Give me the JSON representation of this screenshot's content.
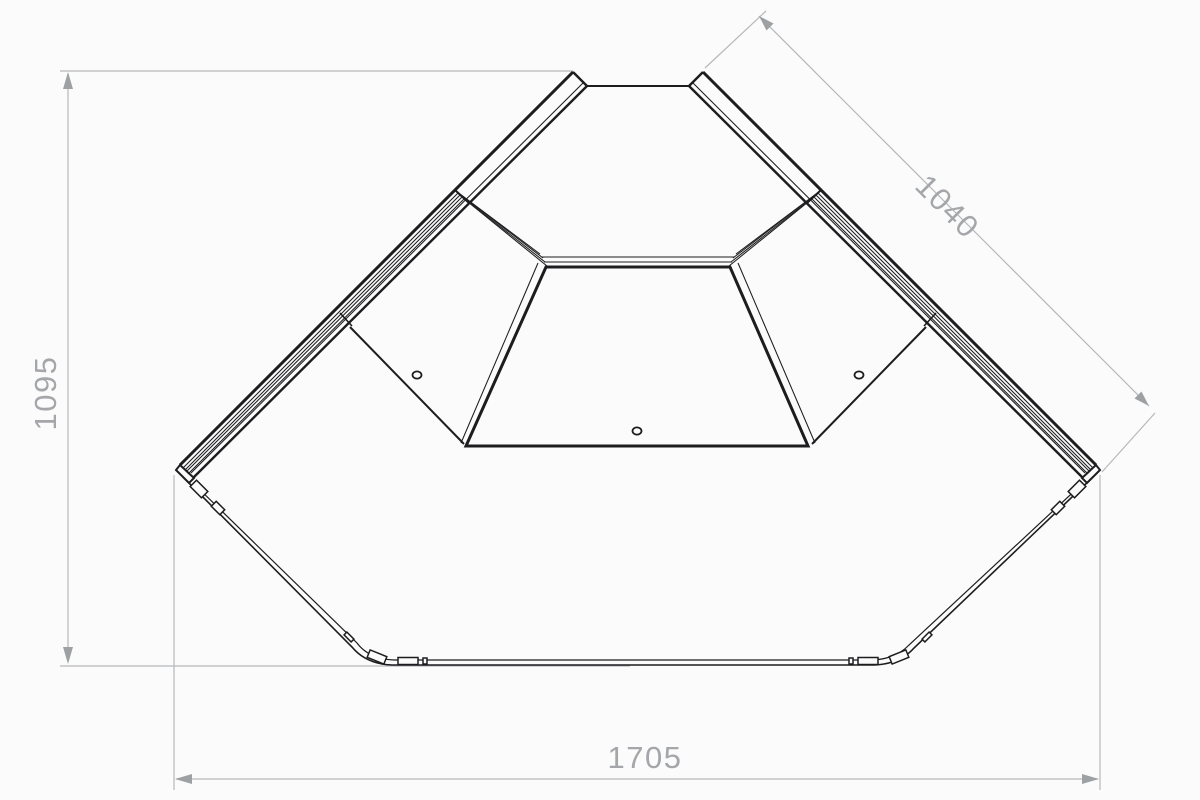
{
  "diagram": {
    "kind": "corner-display-counter-top-view-technical-drawing",
    "labels": {
      "height": "1095",
      "diagonal": "1040",
      "width": "1705"
    },
    "units": "mm",
    "colors": {
      "object_line": "#1d1d1f",
      "dimension_line": "#b6b8ba",
      "dimension_text": "#a4a6a9",
      "background": "#fbfbfb"
    }
  }
}
